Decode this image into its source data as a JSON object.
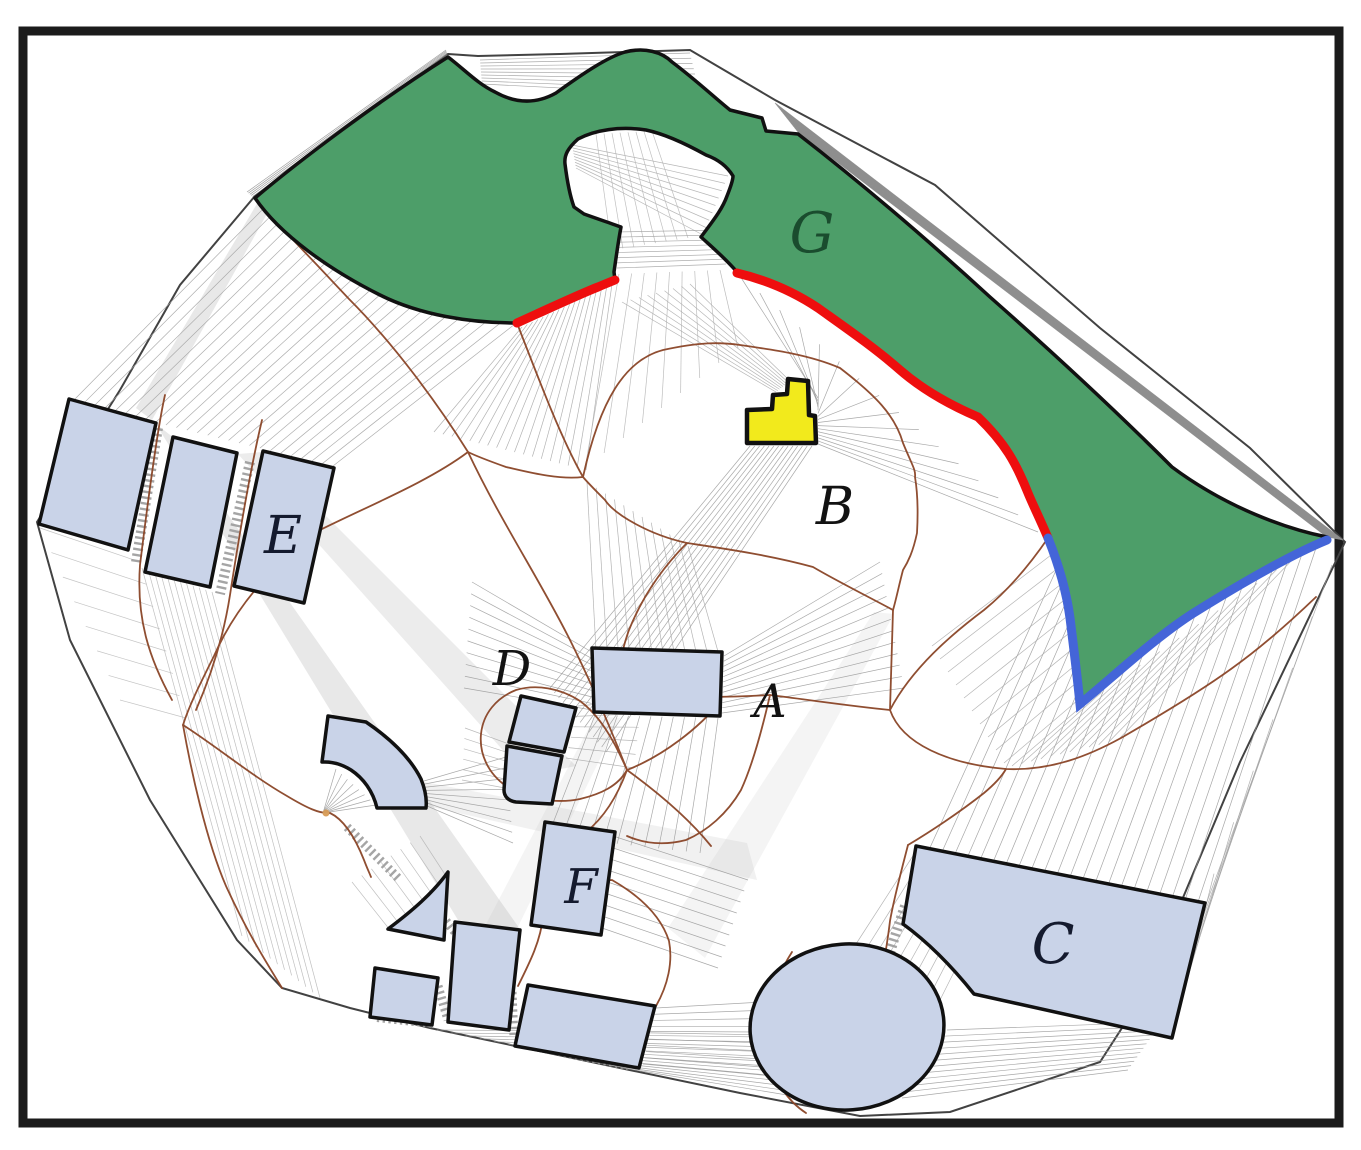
{
  "figure": {
    "kind": "geometric environment map with labeled regions and obstacles",
    "background": "#ffffff"
  },
  "frame": {
    "color": "#1b1b1b"
  },
  "colors": {
    "region_fill": "#4d9e69",
    "region_stroke": "#111111",
    "obstacle_fill": "#c9d3e8",
    "obstacle_stroke": "#111111",
    "highlight_fill": "#f2ea1c",
    "red_boundary": "#ee0e0e",
    "blue_boundary": "#4465d8",
    "medial_axis": "#8a4527",
    "visibility_lines": "#9a9a9a",
    "outer_boundary": "#424242",
    "corridor_hatch": "#9b9b9b",
    "junction_dot": "#d79b56"
  },
  "labels": {
    "G": {
      "text": "G",
      "color": "#1a4c2e"
    },
    "B": {
      "text": "B",
      "color": "#121212"
    },
    "A": {
      "text": "A",
      "color": "#121212"
    },
    "C": {
      "text": "C",
      "color": "#141a2e"
    },
    "D": {
      "text": "D",
      "color": "#121212"
    },
    "E": {
      "text": "E",
      "color": "#141a2e"
    },
    "F": {
      "text": "F",
      "color": "#141a2e"
    }
  }
}
